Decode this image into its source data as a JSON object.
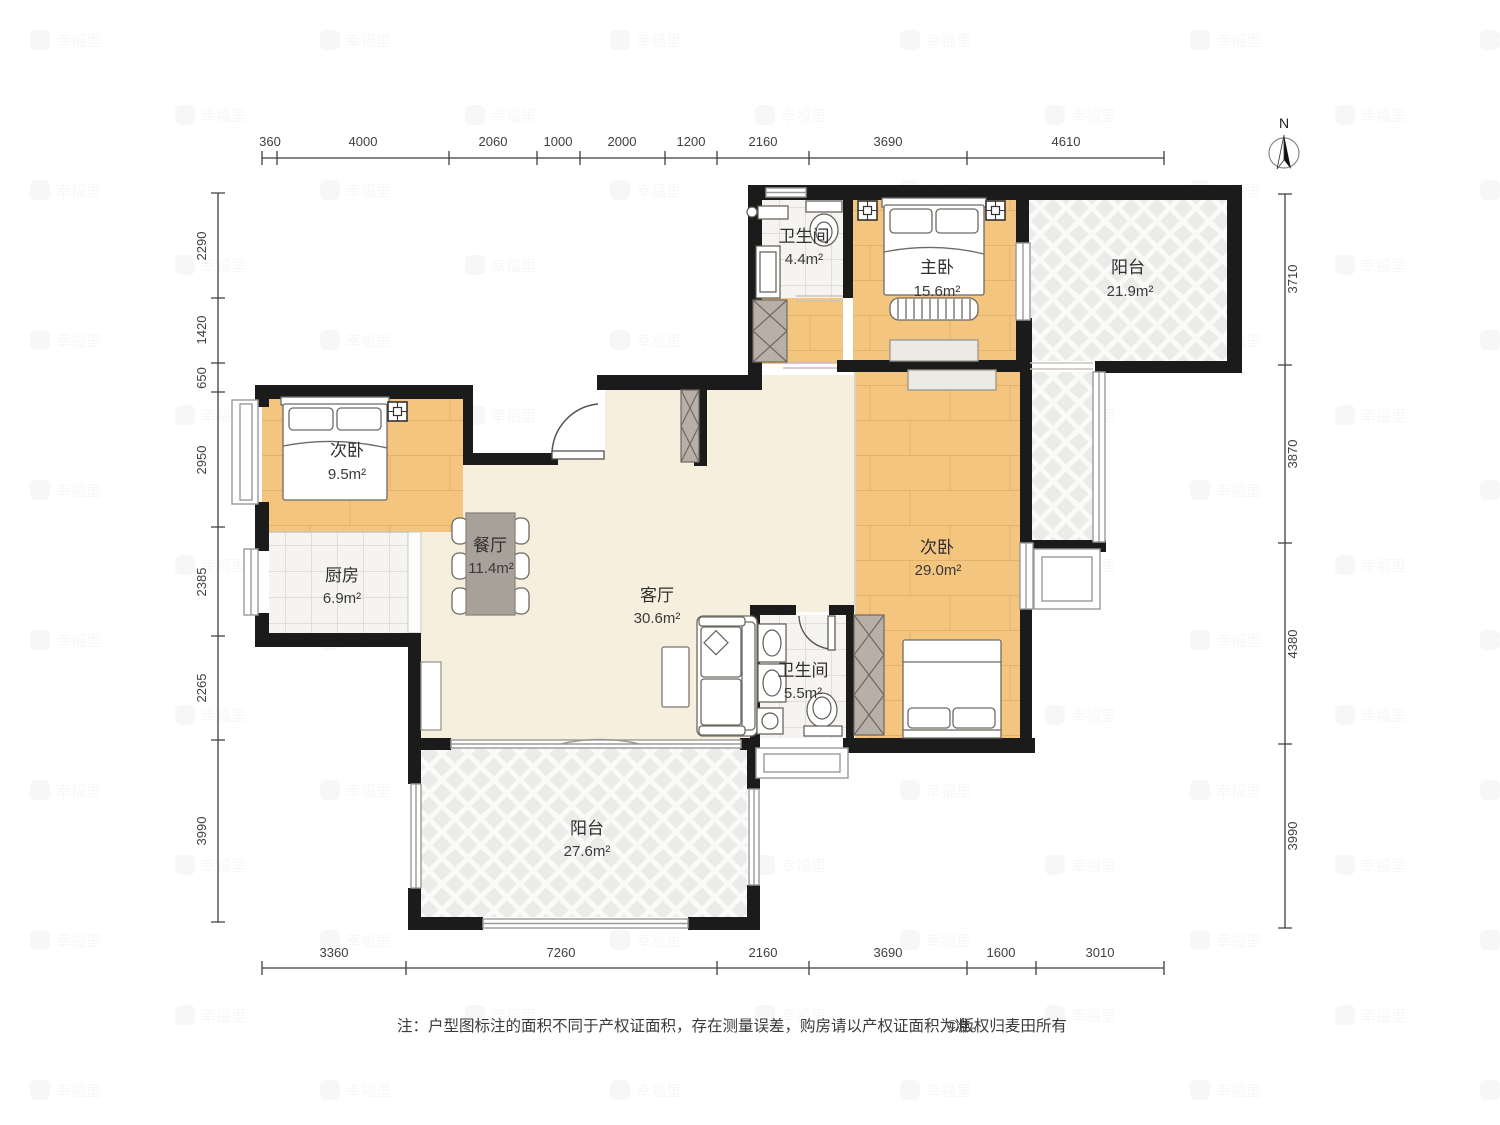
{
  "north": {
    "label": "N"
  },
  "rooms": {
    "bath_top": {
      "label": "卫生间",
      "area": "4.4m²"
    },
    "master": {
      "label": "主卧",
      "area": "15.6m²"
    },
    "balcony_top": {
      "label": "阳台",
      "area": "21.9m²"
    },
    "bedroom_left": {
      "label": "次卧",
      "area": "9.5m²"
    },
    "dining": {
      "label": "餐厅",
      "area": "11.4m²"
    },
    "kitchen": {
      "label": "厨房",
      "area": "6.9m²"
    },
    "living": {
      "label": "客厅",
      "area": "30.6m²"
    },
    "bedroom_right": {
      "label": "次卧",
      "area": "29.0m²"
    },
    "bath_bottom": {
      "label": "卫生间",
      "area": "5.5m²"
    },
    "balcony_bottom": {
      "label": "阳台",
      "area": "27.6m²"
    }
  },
  "dimensions": {
    "top": [
      "360",
      "4000",
      "2060",
      "1000",
      "2000",
      "1200",
      "2160",
      "3690",
      "4610"
    ],
    "bottom": [
      "3360",
      "7260",
      "2160",
      "3690",
      "1600",
      "3010"
    ],
    "left": [
      "2290",
      "1420",
      "650",
      "2950",
      "2385",
      "2265",
      "3990"
    ],
    "right": [
      "3710",
      "3870",
      "4380",
      "3990"
    ]
  },
  "note": {
    "text": "注：户型图标注的面积不同于产权证面积，存在测量误差，购房请以产权证面积为准。",
    "copyright": "©版权归麦田所有"
  },
  "watermark": {
    "text": "幸福里"
  },
  "palette": {
    "wall": "#1b1b1b",
    "wood_floor": "#F3C57E",
    "tile_floor": "#F5F4F1",
    "warm_floor": "#F6EFDE",
    "balcony_hatch": "#EDEDEB",
    "table_gray": "#A8A19A",
    "closet_gray": "#B7AFA8"
  }
}
